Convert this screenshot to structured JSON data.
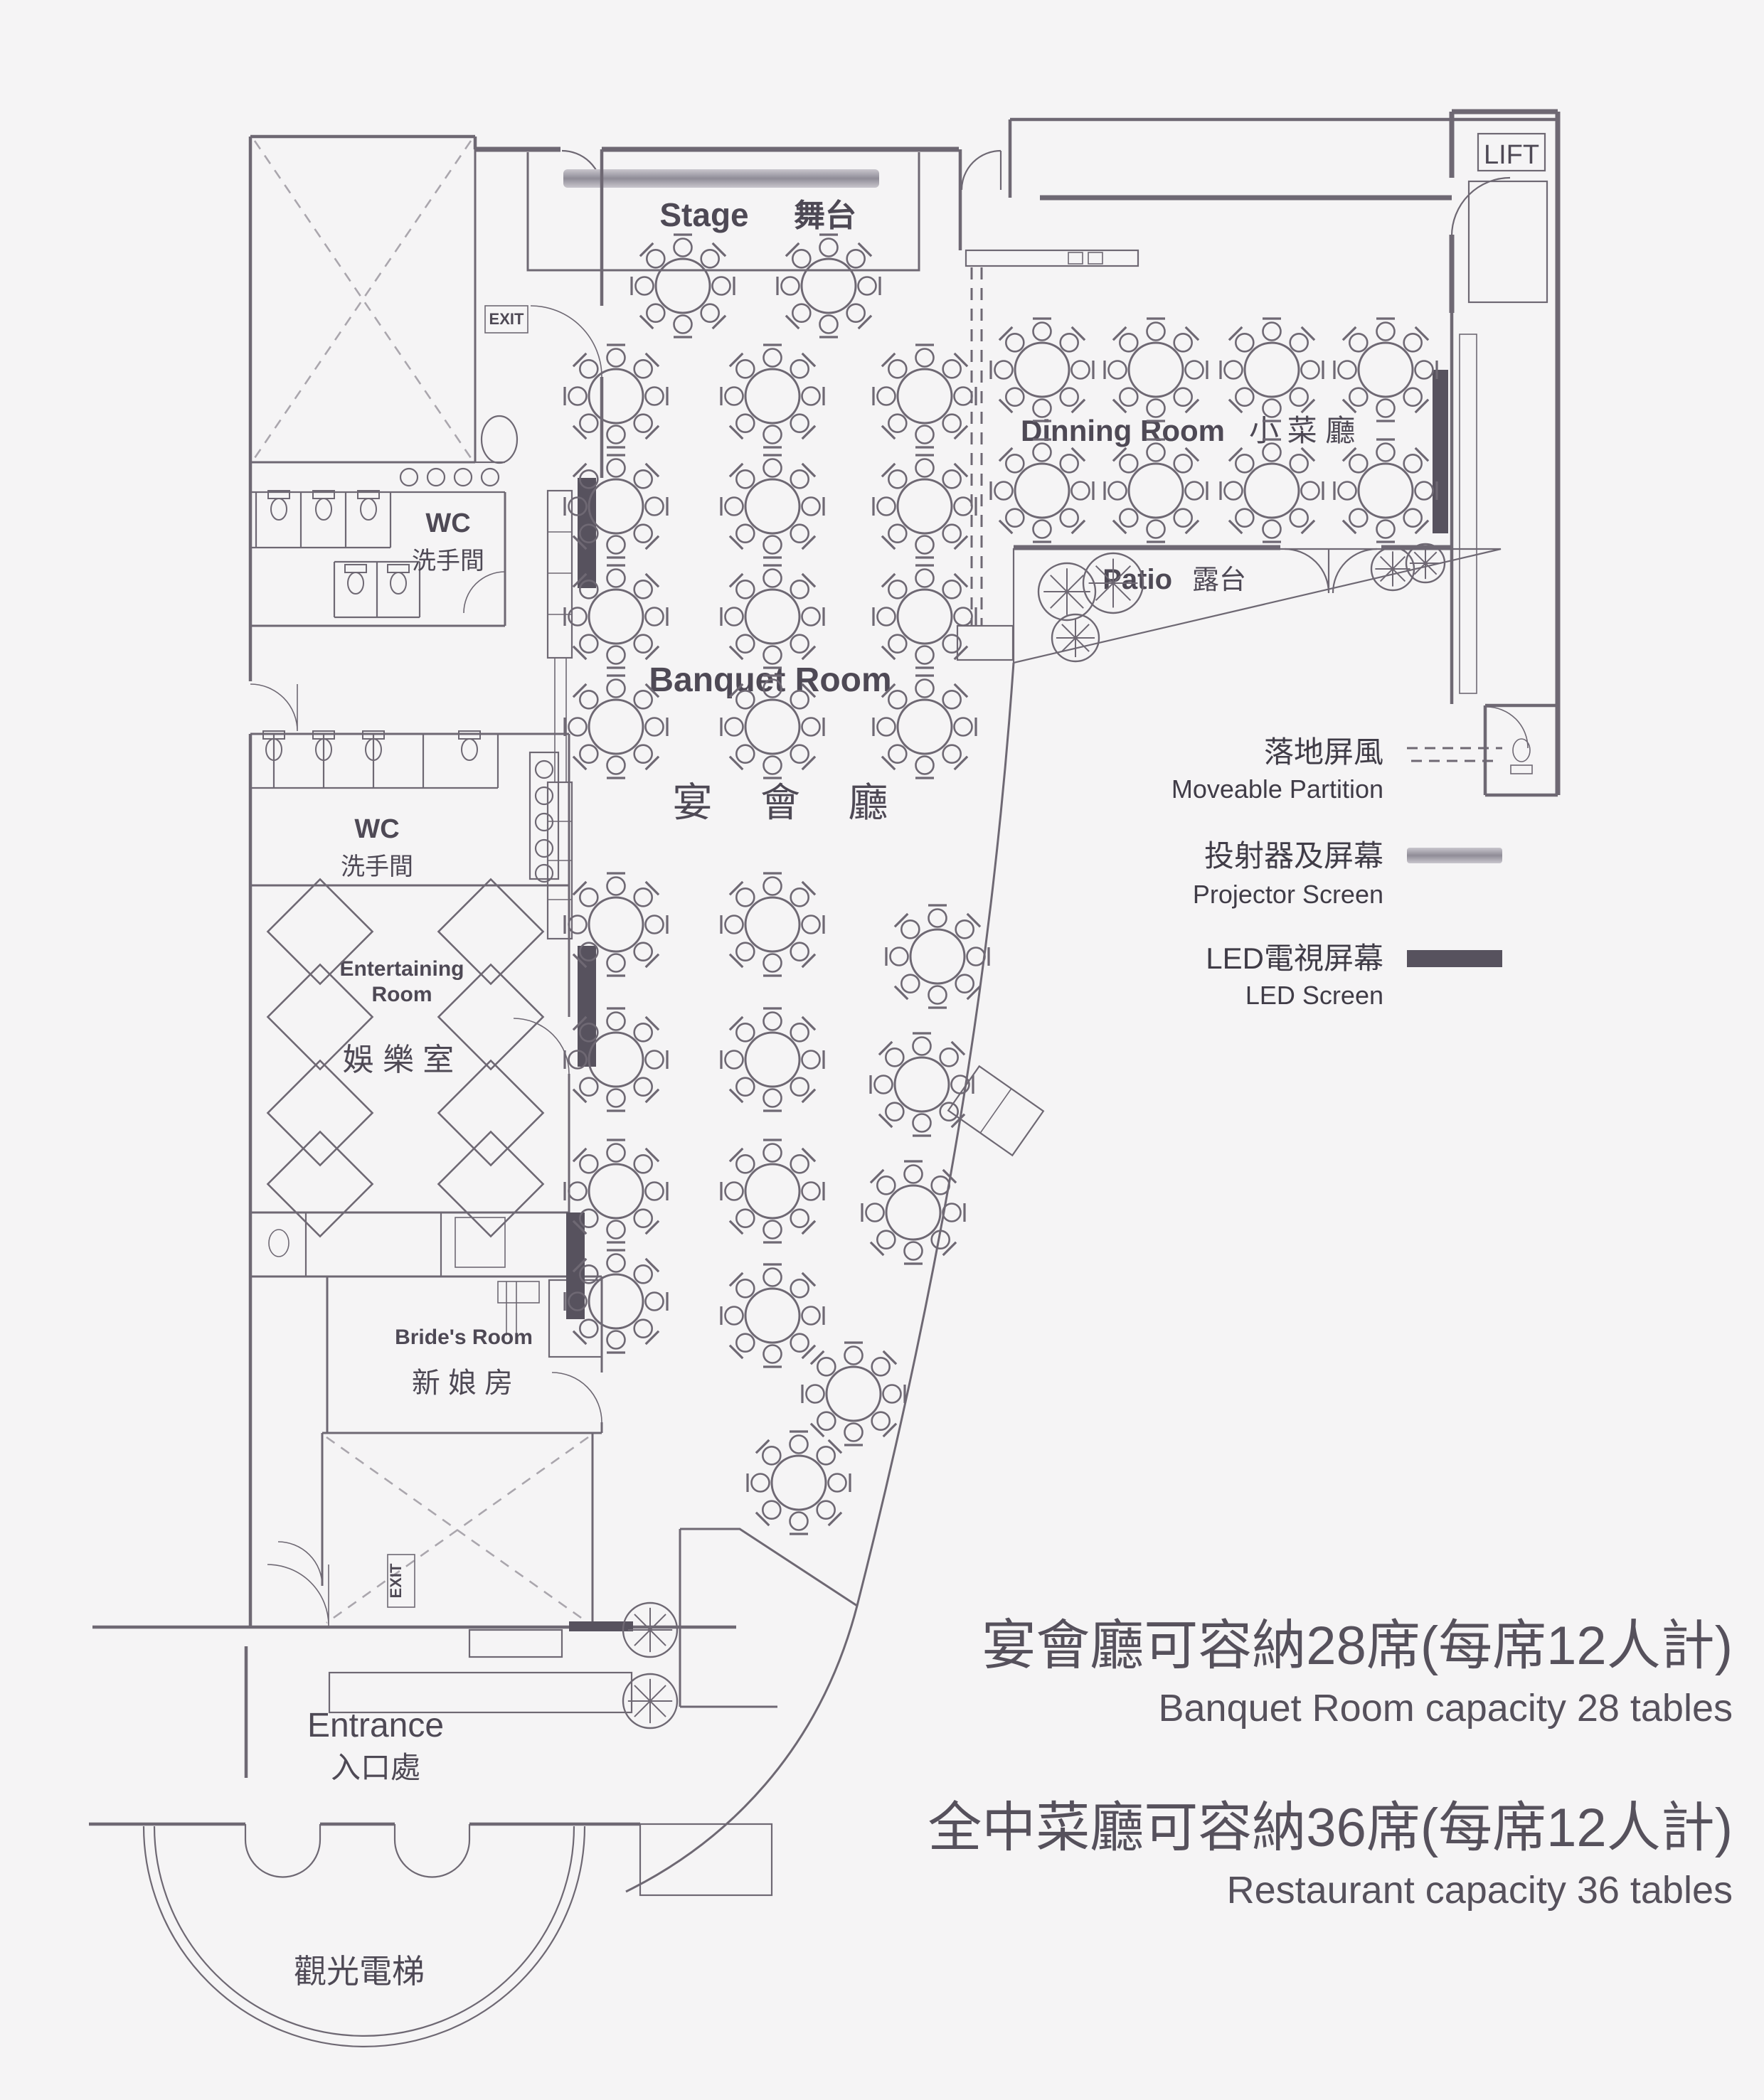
{
  "colors": {
    "background": "#f5f4f5",
    "wall": "#6e6873",
    "dark_bar": "#57525e",
    "text": "#4e4955",
    "projector_gray": "#9b98a2",
    "hatch": "#b9b6bd"
  },
  "rooms": {
    "stage": {
      "en": "Stage",
      "zh": "舞台"
    },
    "banquet": {
      "en": "Banquet Room",
      "zh": "宴  會  廳"
    },
    "dining": {
      "en": "Dinning Room",
      "zh": "小 菜 廳"
    },
    "patio": {
      "en": "Patio",
      "zh": "露台"
    },
    "wc1": {
      "en": "WC",
      "zh": "洗手間"
    },
    "wc2": {
      "en": "WC",
      "zh": "洗手間"
    },
    "entertaining": {
      "en_line1": "Entertaining",
      "en_line2": "Room",
      "zh": "娛 樂 室"
    },
    "brides": {
      "en": "Bride's Room",
      "zh": "新 娘 房"
    },
    "entrance": {
      "en": "Entrance",
      "zh": "入口處"
    },
    "scenic_lift": {
      "zh": "觀光電梯"
    },
    "lift": {
      "label": "LIFT"
    },
    "exit1": {
      "label": "EXIT"
    },
    "exit2": {
      "label": "EXIT"
    }
  },
  "legend": {
    "items": [
      {
        "zh": "落地屏風",
        "en": "Moveable Partition",
        "symbol": "dashed-line"
      },
      {
        "zh": "投射器及屏幕",
        "en": "Projector Screen",
        "symbol": "projector-bar"
      },
      {
        "zh": "LED電視屏幕",
        "en": "LED Screen",
        "symbol": "led-bar"
      }
    ]
  },
  "capacity": {
    "banquet_zh": "宴會廳可容納28席(每席12人計)",
    "banquet_en": "Banquet Room capacity 28 tables",
    "restaurant_zh": "全中菜廳可容納36席(每席12人計)",
    "restaurant_en": "Restaurant capacity 36 tables"
  },
  "plan": {
    "banquet_table_count": 28,
    "dining_table_count": 8,
    "seats_per_table": 12,
    "banquet_tables": [
      [
        960,
        402
      ],
      [
        1165,
        402
      ],
      [
        866,
        557
      ],
      [
        1086,
        557
      ],
      [
        1300,
        557
      ],
      [
        866,
        712
      ],
      [
        1086,
        712
      ],
      [
        1300,
        712
      ],
      [
        866,
        867
      ],
      [
        1086,
        867
      ],
      [
        1300,
        867
      ],
      [
        866,
        1022
      ],
      [
        1086,
        1022
      ],
      [
        1300,
        1022
      ],
      [
        866,
        1300
      ],
      [
        1086,
        1300
      ],
      [
        1318,
        1345
      ],
      [
        866,
        1490
      ],
      [
        1086,
        1490
      ],
      [
        1296,
        1525
      ],
      [
        866,
        1675
      ],
      [
        1086,
        1675
      ],
      [
        1284,
        1705
      ],
      [
        866,
        1830
      ],
      [
        1086,
        1850
      ],
      [
        1200,
        1960
      ],
      [
        1123,
        2085
      ]
    ],
    "dining_tables": [
      [
        1465,
        520
      ],
      [
        1625,
        520
      ],
      [
        1788,
        520
      ],
      [
        1948,
        520
      ],
      [
        1465,
        690
      ],
      [
        1625,
        690
      ],
      [
        1788,
        690
      ],
      [
        1948,
        690
      ]
    ],
    "entertaining_diamonds": [
      [
        450,
        1310
      ],
      [
        690,
        1310
      ],
      [
        450,
        1430
      ],
      [
        690,
        1430
      ],
      [
        450,
        1565
      ],
      [
        690,
        1565
      ],
      [
        450,
        1665
      ],
      [
        690,
        1665
      ]
    ],
    "patio_trees": [
      [
        1500,
        832,
        40
      ],
      [
        1565,
        820,
        42
      ],
      [
        1512,
        897,
        33
      ],
      [
        1958,
        800,
        30
      ],
      [
        2004,
        792,
        27
      ]
    ],
    "entrance_trees": [
      [
        914,
        2292,
        38
      ],
      [
        914,
        2392,
        38
      ]
    ],
    "wc1_toilets": [
      [
        392,
        712
      ],
      [
        455,
        712
      ],
      [
        518,
        712
      ],
      [
        500,
        816
      ],
      [
        560,
        816
      ]
    ],
    "wc2_toilets": [
      [
        385,
        1050
      ],
      [
        455,
        1050
      ],
      [
        525,
        1050
      ],
      [
        660,
        1050
      ]
    ],
    "wc1_sinks": [
      [
        575,
        671
      ],
      [
        613,
        671
      ],
      [
        651,
        671
      ],
      [
        689,
        671
      ]
    ],
    "wc2_sinks": [
      [
        765,
        1082
      ],
      [
        765,
        1119
      ],
      [
        765,
        1156
      ],
      [
        765,
        1193
      ],
      [
        765,
        1228
      ]
    ]
  }
}
